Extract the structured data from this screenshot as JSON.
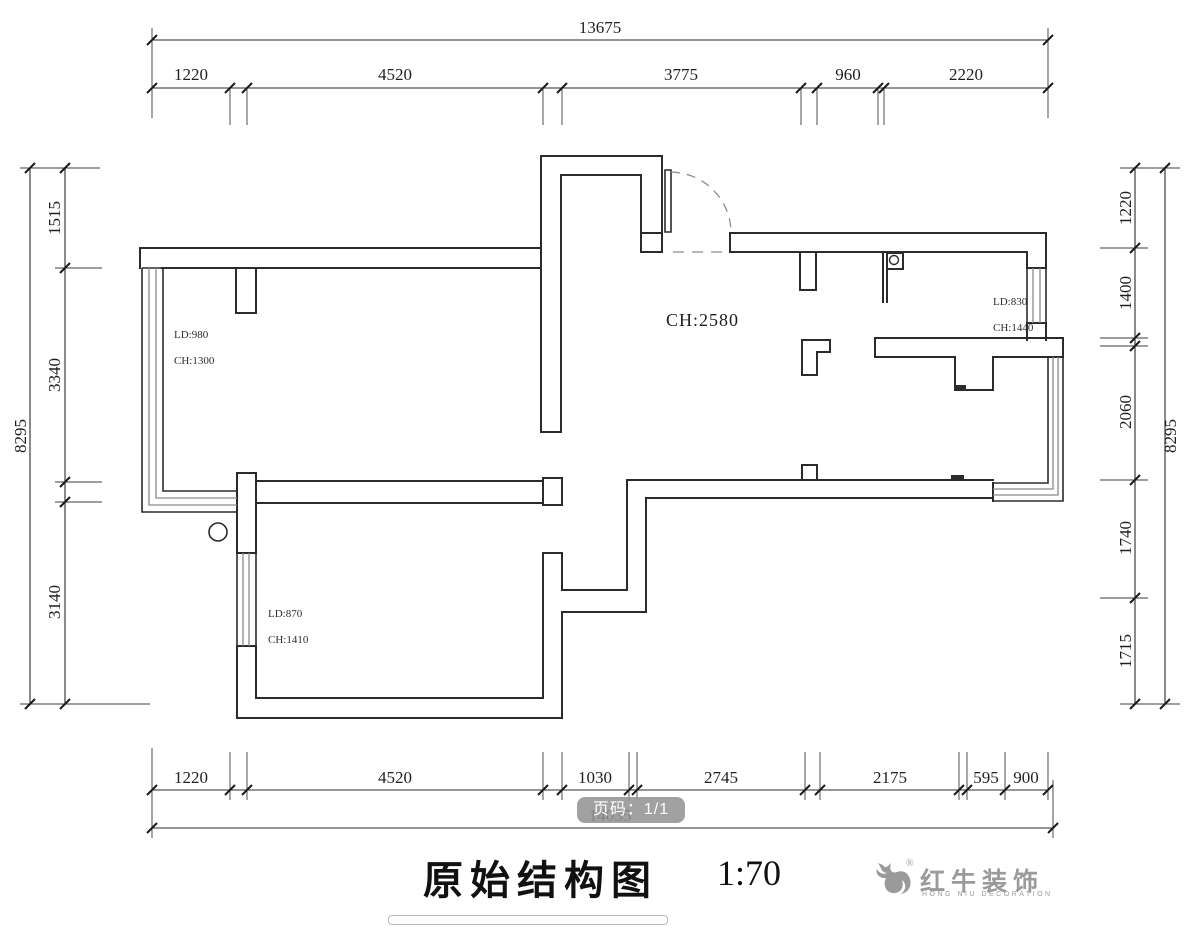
{
  "drawing": {
    "title": "原始结构图",
    "scale": "1:70"
  },
  "footer": {
    "page_badge": "页码：1/1"
  },
  "plan": {
    "ceiling_label": "CH:2580",
    "windows": {
      "left": {
        "ld": "LD:980",
        "ch": "CH:1300"
      },
      "right": {
        "ld": "LD:830",
        "ch": "CH:1440"
      },
      "lower": {
        "ld": "LD:870",
        "ch": "CH:1410"
      }
    }
  },
  "dimensions": {
    "top_total": "13675",
    "top_segments": [
      "1220",
      "4520",
      "3775",
      "960",
      "2220"
    ],
    "bottom_segments": [
      "1220",
      "4520",
      "1030",
      "2745",
      "2175",
      "595",
      "900"
    ],
    "bottom_total": "14035",
    "left_total": "8295",
    "left_segments": [
      "1515",
      "3340",
      "3140"
    ],
    "right_total": "8295",
    "right_segments": [
      "1220",
      "1400",
      "2060",
      "1740",
      "1715"
    ]
  },
  "logo": {
    "registered": "®",
    "name": "红牛装饰",
    "subtitle": "HONG NIU DECORATION"
  },
  "colors": {
    "line": "#2b2b2b",
    "window_line": "#8a8a8a",
    "badge_bg": "#949494",
    "logo_gray": "#9a9a9a"
  }
}
